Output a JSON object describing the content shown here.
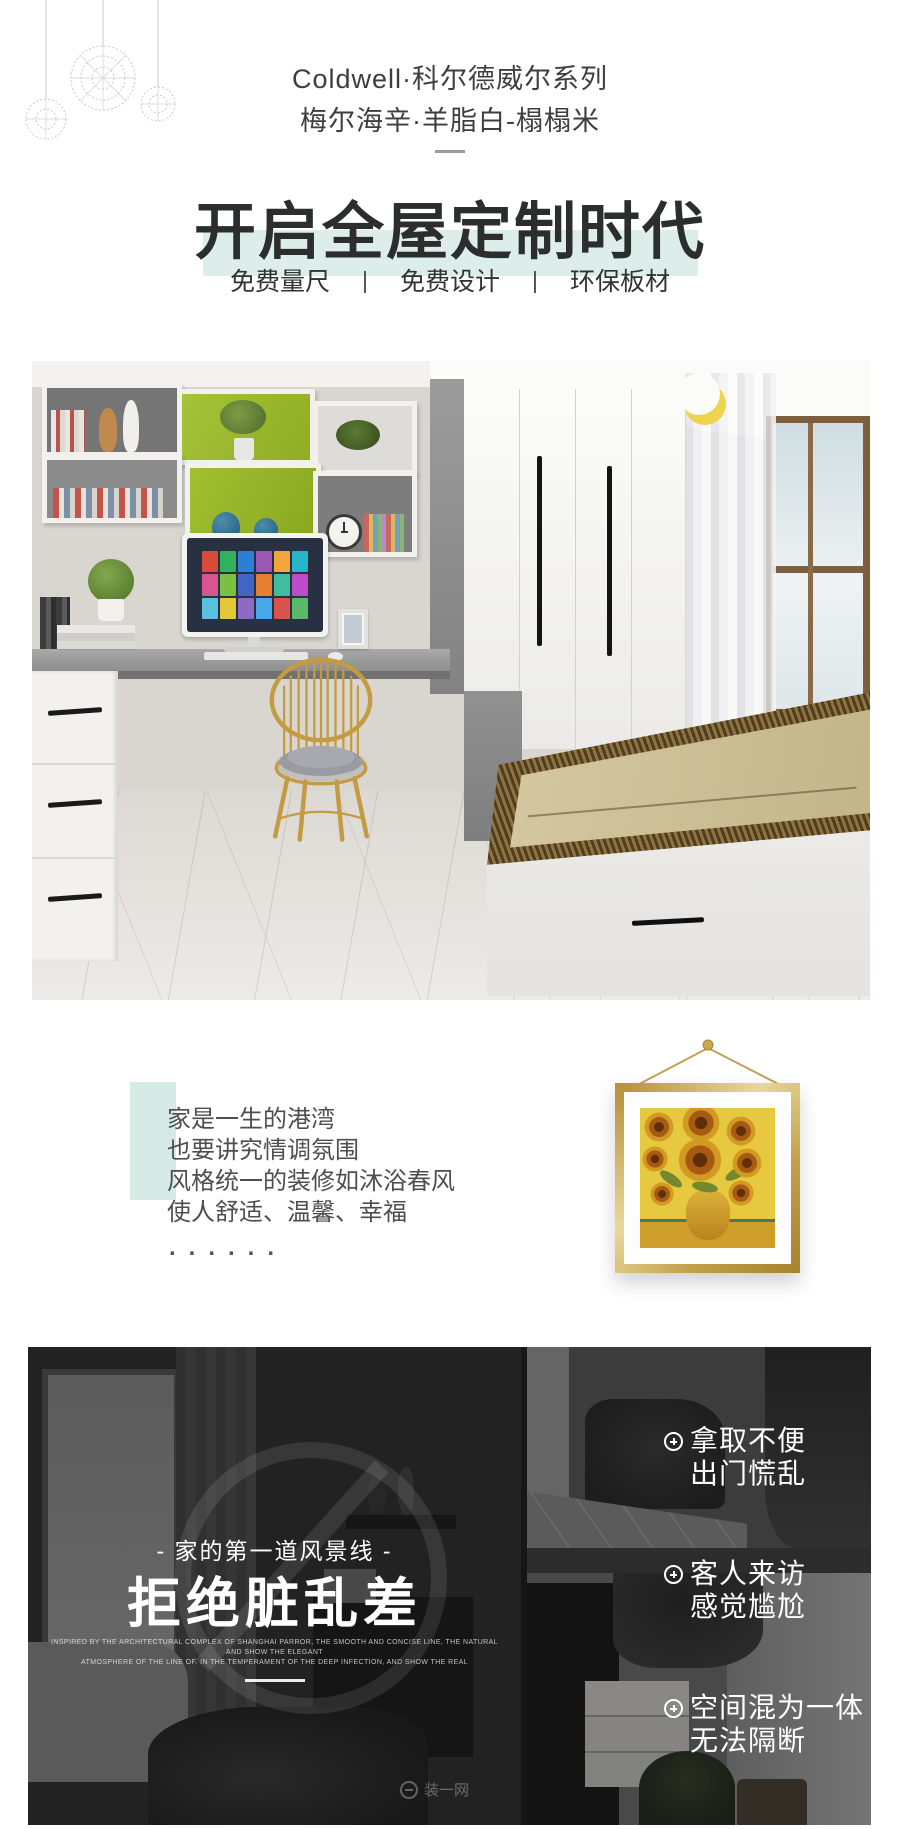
{
  "header": {
    "brand_line": "Coldwell·科尔德威尔系列",
    "series_line": "梅尔海辛·羊脂白-榻榻米",
    "title": "开启全屋定制时代",
    "features": [
      "免费量尺",
      "免费设计",
      "环保板材"
    ],
    "separator": "|"
  },
  "quote": {
    "lines": [
      "家是一生的港湾",
      "也要讲究情调氛围",
      "风格统一的装修如沐浴春风",
      "使人舒适、温馨、幸福"
    ],
    "dots": "......"
  },
  "problem_section": {
    "tagline": "- 家的第一道风景线 -",
    "headline": "拒绝脏乱差",
    "caption_line1": "INSPIRED BY THE ARCHITECTURAL COMPLEX OF SHANGHAI PARROR, THE SMOOTH AND CONCISE LINE, THE NATURAL AND SHOW THE ELEGANT",
    "caption_line2": "ATMOSPHERE OF THE LINE OF. IN THE TEMPERAMENT OF THE DEEP INFECTION, AND SHOW THE REAL",
    "bullets": [
      {
        "line1": "拿取不便",
        "line2": "出门慌乱"
      },
      {
        "line1": "客人来访",
        "line2": "感觉尴尬"
      },
      {
        "line1": "空间混为一体",
        "line2": "无法隔断"
      }
    ],
    "watermark": "装一网"
  },
  "colors": {
    "accent_mint": "#ddeeea",
    "quote_accent": "#d6ebe5",
    "title_text": "#2c2e2e",
    "body_text": "#4e4e4e",
    "dark_bg": "#161616",
    "gold_frame": "#c9a64b",
    "shelf_green": "#9cba2c"
  }
}
